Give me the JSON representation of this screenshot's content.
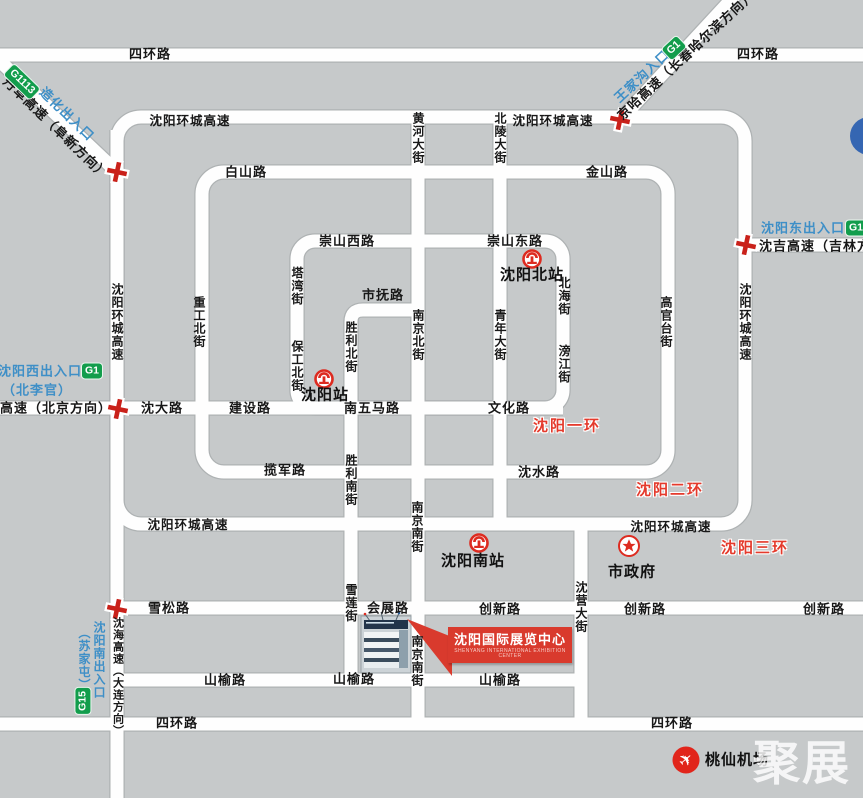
{
  "map_labels": {
    "sihuan": "四环路",
    "huancheng": "沈阳环城高速",
    "baishan": "白山路",
    "jinshan": "金山路",
    "chongshan_xi": "崇山西路",
    "chongshan_dong": "崇山东路",
    "tawan": "塔湾街",
    "shifu": "市抚路",
    "zhonggong_bei": "重工北街",
    "huanghe": "黄河大街",
    "beiling": "北陵大街",
    "nanjing_bei": "南京北街",
    "qingnian": "青年大街",
    "beihai": "北海街",
    "pangjiang": "滂江街",
    "baogong_bei": "保工北街",
    "shengli_bei": "胜利北街",
    "shengli_nan": "胜利南街",
    "xuelian": "雪莲街",
    "nanjing_nan": "南京南街",
    "shenda": "沈大路",
    "jianshe": "建设路",
    "nanwuma": "南五马路",
    "wenhua": "文化路",
    "lanjun": "揽军路",
    "shenshui": "沈水路",
    "xuesong": "雪松路",
    "huizhan": "会展路",
    "chuangxin": "创新路",
    "shanyu": "山榆路",
    "shenying": "沈营大街",
    "gaoguantai": "高官台街",
    "shenhai": "沈海高速（大连方向）"
  },
  "highways": {
    "danfu": "丹阜高速（阜新方向）",
    "jingha_changchun": "京哈高速（长春哈尔滨方向）",
    "jingha_beijing": "京哈高速（北京方向）",
    "shenji": "沈吉高速（吉林方向）"
  },
  "entrances": {
    "zaohua": {
      "label": "造化出入口",
      "badge": "G1113"
    },
    "wangjiagou": {
      "label": "王家沟入口",
      "badge": "G1"
    },
    "west": {
      "label": "沈阳西出入口",
      "sub": "（北李官）",
      "badge": "G1"
    },
    "east": {
      "label": "沈阳东出入口",
      "badge": "G1"
    },
    "south": {
      "label": "沈阳南出入口",
      "sub": "（苏家屯）",
      "badge": "G15"
    }
  },
  "ring_labels": {
    "one": "沈阳一环",
    "two": "沈阳二环",
    "three": "沈阳三环"
  },
  "stations": {
    "main": "沈阳站",
    "north": "沈阳北站",
    "south": "沈阳南站"
  },
  "poi": {
    "city_hall": "市政府",
    "airport": "桃仙机场",
    "exhibition_title": "沈阳国际展览中心",
    "exhibition_subtitle": "SHENYANG INTERNATIONAL EXHIBITION CENTER"
  },
  "watermark": "聚展",
  "colors": {
    "background": "#c6c9ca",
    "road": "#ffffff",
    "road_edge": "#aeb2b3",
    "blue_label": "#3e8fc7",
    "green_badge": "#129d4c",
    "cross_red": "#c9211a",
    "ring_red": "#e43a2c",
    "callout_red": "#d93a2d"
  }
}
